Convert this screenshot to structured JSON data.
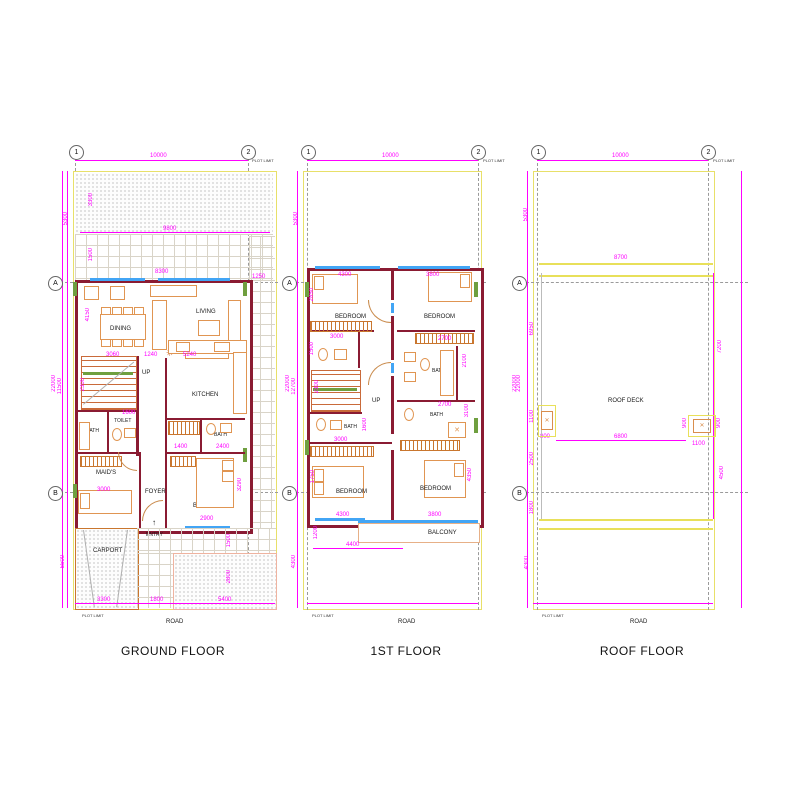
{
  "colors": {
    "dimension": "#ff00ff",
    "wall": "#8a1b32",
    "furniture": "#e09552",
    "window": "#42a5f5",
    "plot_line": "#e8e069",
    "green_accent": "#6f9f3f"
  },
  "axes": {
    "col1": "1",
    "col2": "2",
    "rowA": "A",
    "rowB": "B"
  },
  "common": {
    "road": "ROAD",
    "plot_limit": "PLOT LIMIT",
    "up": "UP",
    "entry": "ENTRY"
  },
  "ground": {
    "title": "GROUND FLOOR",
    "rooms": {
      "dining": "DINING",
      "living": "LIVING",
      "kitchen": "KITCHEN",
      "toilet": "TOILET",
      "bath_left": "BATH",
      "bath_right": "BATH",
      "maids": "MAID'S",
      "foyer": "FOYER",
      "bedroom": "BEDROOM",
      "carport": "CARPORT"
    },
    "dims": {
      "total_width": "10000",
      "front_setback": "5300",
      "total_depth": "22000",
      "inner_depth": "11500",
      "rear_setback": "5500",
      "garden_depth": "3300",
      "garden_width": "9800",
      "walkway": "1500",
      "living_width": "8300",
      "side_offset": "1250",
      "living_depth": "4150",
      "dining_width": "3060",
      "hall_width": "1240",
      "sofa_width": "5240",
      "stair_depth": "2300",
      "toilet_width": "1600",
      "bath_width": "1400",
      "bath_right_width": "2400",
      "maids_width": "3000",
      "bedroom_width": "2900",
      "bedroom_depth": "3290",
      "carport_width": "3300",
      "entry_width": "1800",
      "yard_width": "5400",
      "yard_depth": "2800",
      "entry_depth": "1500"
    }
  },
  "first": {
    "title": "1ST FLOOR",
    "rooms": {
      "bedroom_tl": "BEDROOM",
      "bedroom_tr": "BEDROOM",
      "bedroom_bl": "BEDROOM",
      "bedroom_br": "BEDROOM",
      "bath_left": "BATH",
      "bath_tr": "BATH",
      "bath_br": "BATH",
      "balcony": "BALCONY"
    },
    "dims": {
      "total_width": "10000",
      "front_setback": "5300",
      "total_depth": "22000",
      "inner_depth": "12700",
      "rear_setback": "4300",
      "bedroom_tl_width": "4300",
      "bedroom_tr_width": "3800",
      "bedroom_tl_depth": "2850",
      "wardrobe_width": "3000",
      "bath_depth": "1500",
      "stair_depth": "2300",
      "bath_left_depth": "1600",
      "bath_left_width": "3000",
      "bedroom_bl_depth": "1750",
      "bedroom_bl_width": "4300",
      "balcony_depth": "1200",
      "balcony_width": "4400",
      "bedroom_br_width": "3800",
      "bedroom_br_depth": "4350",
      "wardrobe_tr_width": "2700",
      "bath_tr_depth": "2100",
      "bath_tr_width": "2700",
      "bath_br_depth": "3100",
      "right_depth": "22000"
    }
  },
  "roof": {
    "title": "ROOF FLOOR",
    "rooms": {
      "deck": "ROOF DECK"
    },
    "dims": {
      "total_width": "10000",
      "front_setback": "5300",
      "total_depth": "22000",
      "parapet_width": "8700",
      "deck_front": "6950",
      "skylight_left_depth": "1100",
      "skylight_left_offset": "800",
      "mid_depth": "2500",
      "rear_inner": "1800",
      "rear_setback": "4300",
      "deck_span": "6800",
      "skylight_right_offset": "1100",
      "skylight_right_depth": "900",
      "skylight_right_depth2": "900",
      "right_depth": "4500",
      "right_front": "7200"
    }
  }
}
